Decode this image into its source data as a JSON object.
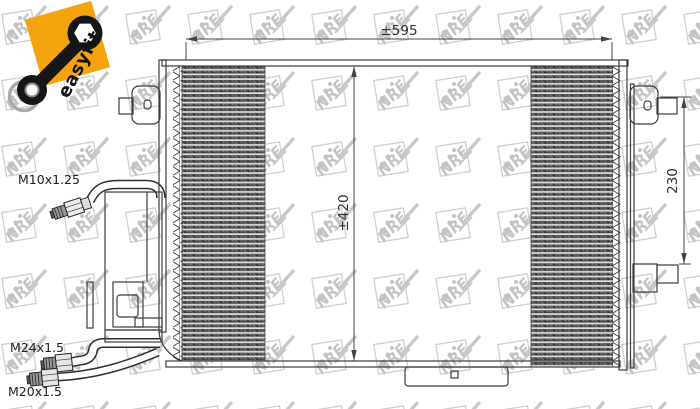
{
  "badge": {
    "label": "easyfit"
  },
  "watermark": {
    "brand": "NRF",
    "color": "#c8c8c8"
  },
  "drawing": {
    "title": "condenser-technical-drawing",
    "dimensions": {
      "width_label": "±595",
      "height_label": "±420",
      "bracket_spacing_label": "230"
    },
    "fittings": {
      "valve_thread": "M10x1.25",
      "inlet_thread": "M24x1.5",
      "outlet_thread": "M20x1.5"
    },
    "colors": {
      "line": "#3c3c3c",
      "accent_orange": "#f5a30c",
      "watermark_gray": "#c8c8c8",
      "core_dark": "#4d4d4d"
    }
  }
}
